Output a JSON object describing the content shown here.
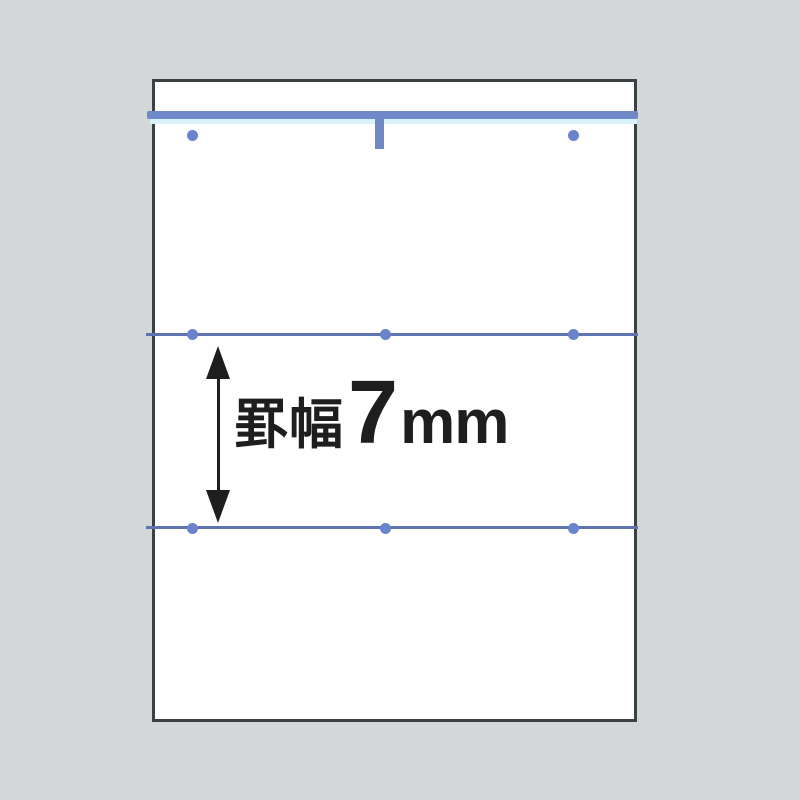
{
  "annotation": {
    "full_label": "罫幅7mm",
    "prefix": "罫幅",
    "number": "7",
    "unit": "mm"
  },
  "colors": {
    "background": "#d3d7d8",
    "paper": "#fefefe",
    "paper-border": "#3b4042",
    "header-line": "#6e88c8",
    "header-glow": "#d9f1f9",
    "rule-line": "#5d74b0",
    "dot": "#6b83cd",
    "ink": "#1e1e1e"
  }
}
